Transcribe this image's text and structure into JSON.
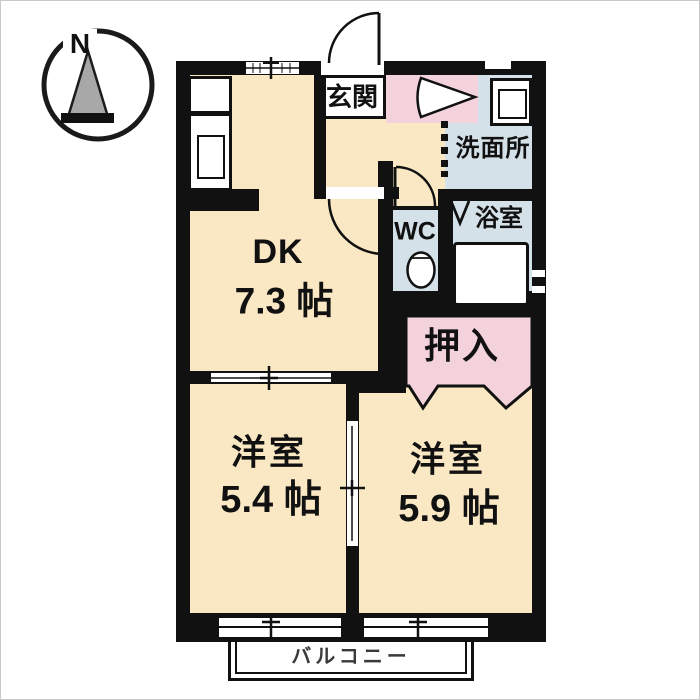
{
  "compass": {
    "north_label": "N"
  },
  "rooms": {
    "dk": {
      "name": "DK",
      "size": "7.3 帖"
    },
    "bedroom_left": {
      "name": "洋室",
      "size": "5.4 帖"
    },
    "bedroom_right": {
      "name": "洋室",
      "size": "5.9 帖"
    },
    "entrance": {
      "label": "玄関"
    },
    "washroom": {
      "label": "洗面所"
    },
    "wc": {
      "label": "WC"
    },
    "bathroom": {
      "label": "浴室"
    },
    "closet": {
      "label": "押入"
    },
    "balcony": {
      "label": "バルコニー"
    }
  },
  "colors": {
    "room_beige": "#FAE7C4",
    "wet_blue": "#D5E1E9",
    "closet_pink": "#F3D2DC",
    "wall_black": "#111111",
    "balcony_text": "#3A3A3A"
  }
}
